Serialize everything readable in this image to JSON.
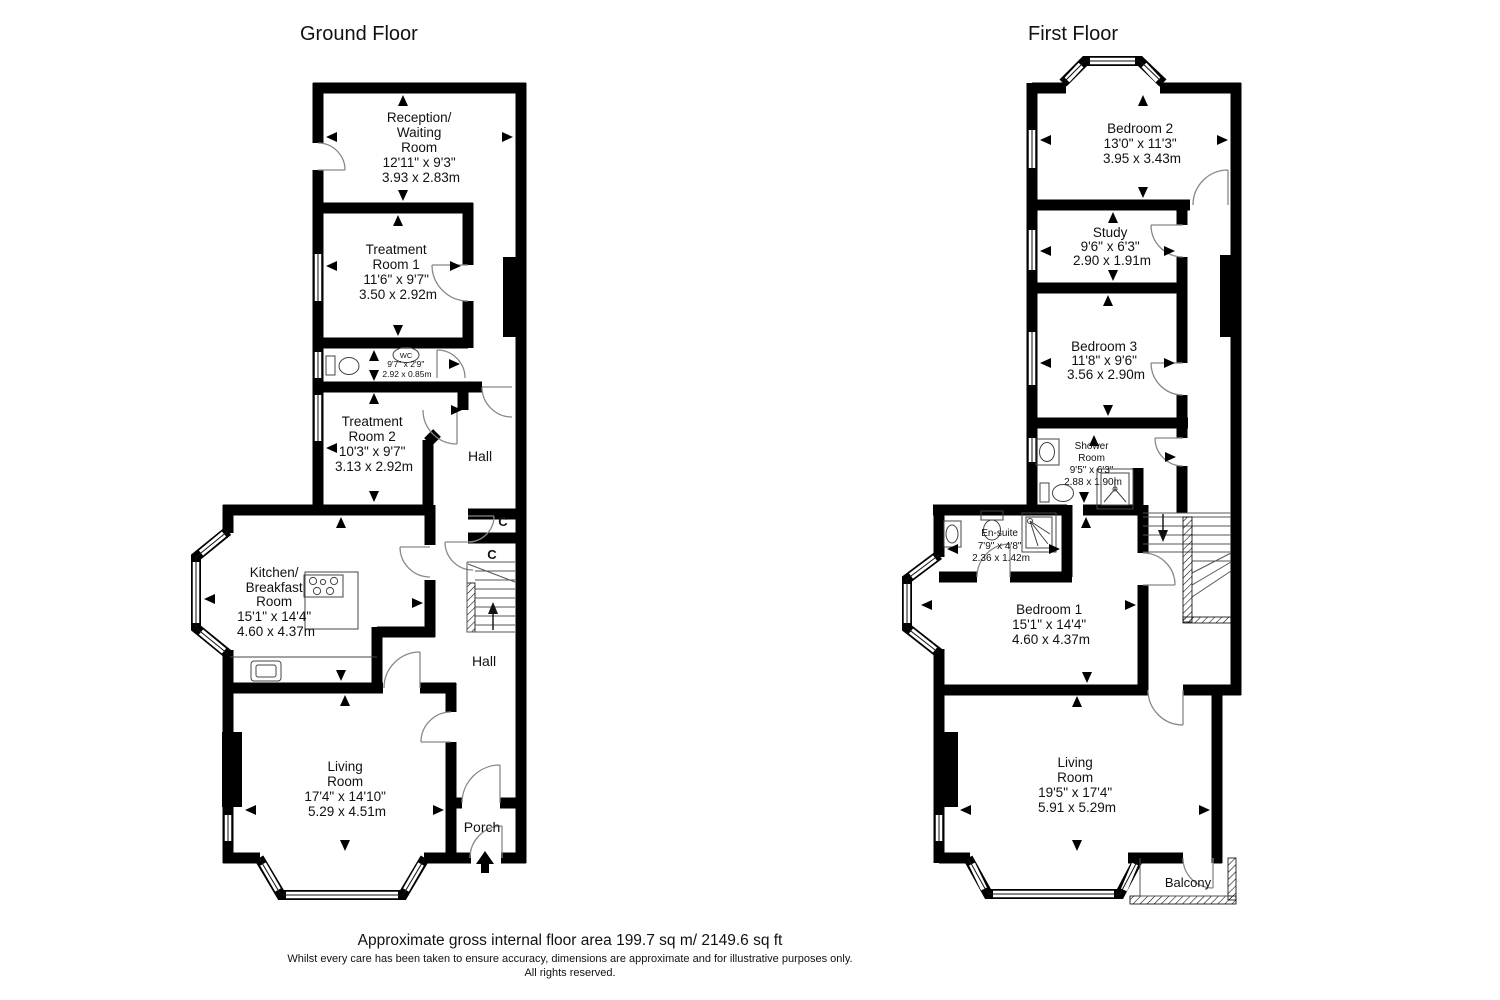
{
  "page": {
    "background": "#ffffff",
    "wall_color": "#000000"
  },
  "titles": {
    "ground": "Ground Floor",
    "first": "First Floor"
  },
  "ground": {
    "reception": {
      "lines": [
        "Reception/",
        "Waiting",
        "Room",
        "12'11\" x 9'3\"",
        "3.93 x 2.83m"
      ]
    },
    "treatment1": {
      "lines": [
        "Treatment",
        "Room 1",
        "11'6\" x 9'7\"",
        "3.50 x 2.92m"
      ]
    },
    "wc": {
      "label": "WC",
      "lines": [
        "9'7\" x 2'9\"",
        "2.92 x 0.85m"
      ]
    },
    "treatment2": {
      "lines": [
        "Treatment",
        "Room 2",
        "10'3\" x 9'7\"",
        "3.13 x 2.92m"
      ]
    },
    "hall_upper": "Hall",
    "hall_lower": "Hall",
    "closet_upper": "C",
    "closet_lower": "C",
    "kitchen": {
      "lines": [
        "Kitchen/",
        "Breakfast",
        "Room",
        "15'1\" x 14'4\"",
        "4.60 x 4.37m"
      ]
    },
    "living": {
      "lines": [
        "Living",
        "Room",
        "17'4\" x 14'10\"",
        "5.29 x 4.51m"
      ]
    },
    "porch": "Porch"
  },
  "first": {
    "bedroom2": {
      "lines": [
        "Bedroom 2",
        "13'0\" x 11'3\"",
        "3.95 x 3.43m"
      ]
    },
    "study": {
      "lines": [
        "Study",
        "9'6\" x 6'3\"",
        "2.90 x 1.91m"
      ]
    },
    "bedroom3": {
      "lines": [
        "Bedroom 3",
        "11'8\" x 9'6\"",
        "3.56 x 2.90m"
      ]
    },
    "shower_room": {
      "lines": [
        "Shower",
        "Room",
        "9'5\" x 6'3\"",
        "2.88 x 1.90m"
      ]
    },
    "ensuite": {
      "lines": [
        "En-suite",
        "7'9\" x 4'8\"",
        "2.36 x 1.42m"
      ]
    },
    "bedroom1": {
      "lines": [
        "Bedroom 1",
        "15'1\" x 14'4\"",
        "4.60 x 4.37m"
      ]
    },
    "living": {
      "lines": [
        "Living",
        "Room",
        "19'5\" x 17'4\"",
        "5.91 x 5.29m"
      ]
    },
    "balcony": "Balcony"
  },
  "footer": {
    "area": "Approximate gross internal floor area 199.7 sq m/ 2149.6 sq ft",
    "disclaimer": "Whilst every care has been taken to ensure accuracy, dimensions are approximate and for illustrative purposes only.",
    "rights": "All rights reserved."
  }
}
